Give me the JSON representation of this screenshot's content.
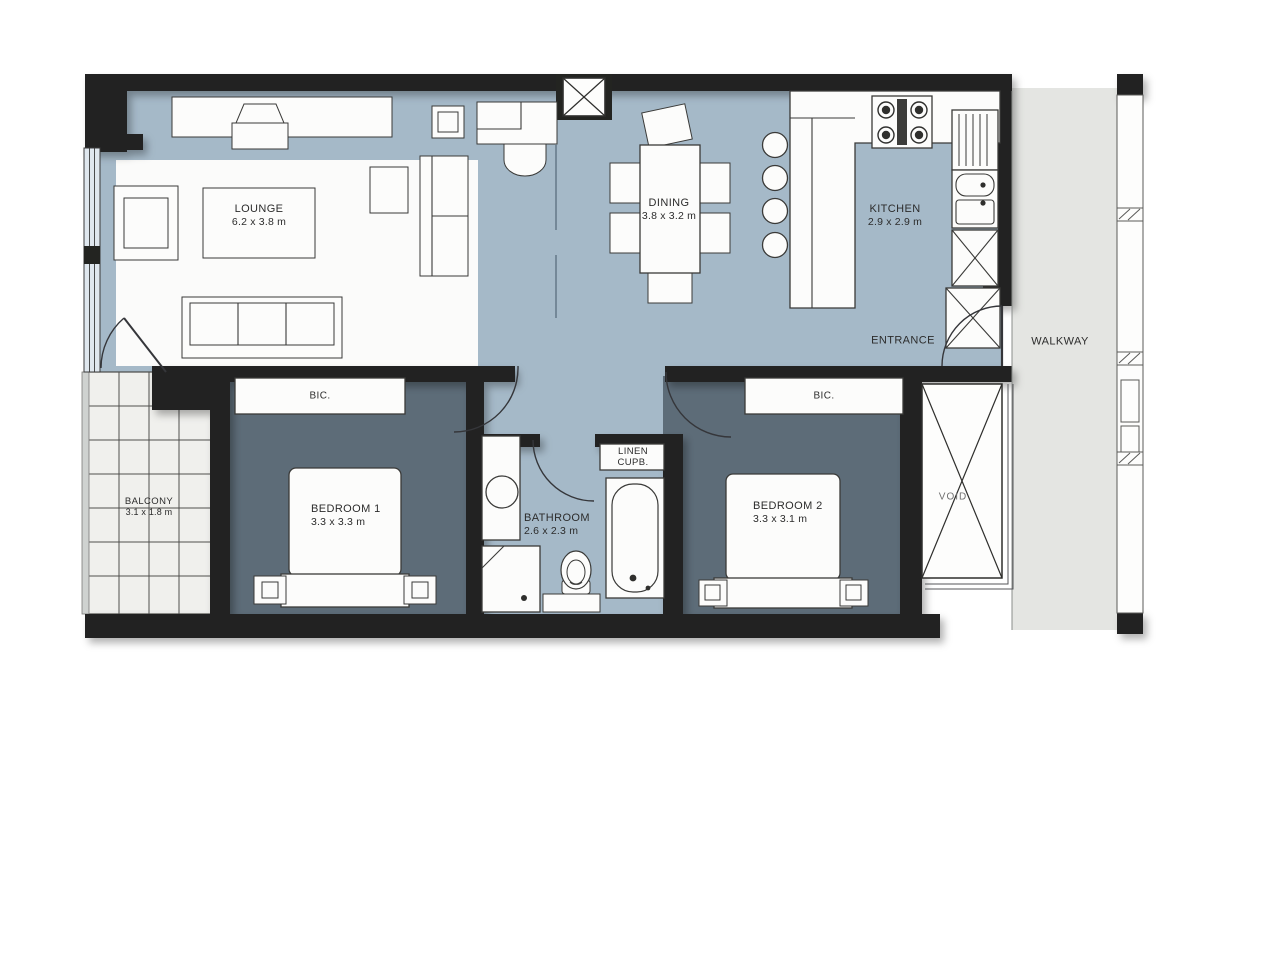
{
  "colors": {
    "wall": "#232421",
    "living": "#a5b9c8",
    "bedroom": "#5d6c78",
    "lounge": "#fbfbfa",
    "walkway": "#e4e5e2",
    "balcony": "#f0f0ed",
    "furn": "#fcfcfb",
    "line": "#3a3a38",
    "voidtext": "#707070",
    "labeltext": "#2c2c2c"
  },
  "labels": {
    "lounge": {
      "name": "LOUNGE",
      "dims": "6.2 x 3.8 m"
    },
    "dining": {
      "name": "DINING",
      "dims": "3.8 x 3.2 m"
    },
    "kitchen": {
      "name": "KITCHEN",
      "dims": "2.9 x 2.9 m"
    },
    "entrance": {
      "name": "ENTRANCE"
    },
    "walkway": {
      "name": "WALKWAY"
    },
    "balcony": {
      "name": "BALCONY",
      "dims": "3.1 x 1.8 m"
    },
    "bedroom1": {
      "name": "BEDROOM 1",
      "dims": "3.3 x 3.3 m"
    },
    "bedroom2": {
      "name": "BEDROOM 2",
      "dims": "3.3 x 3.1 m"
    },
    "bathroom": {
      "name": "BATHROOM",
      "dims": "2.6 x 2.3 m"
    },
    "linen": {
      "name": "LINEN",
      "name2": "CUPB."
    },
    "void": {
      "name": "VOID"
    },
    "bic_bedroom1": {
      "name": "BIC."
    },
    "bic_bedroom2": {
      "name": "BIC."
    }
  }
}
